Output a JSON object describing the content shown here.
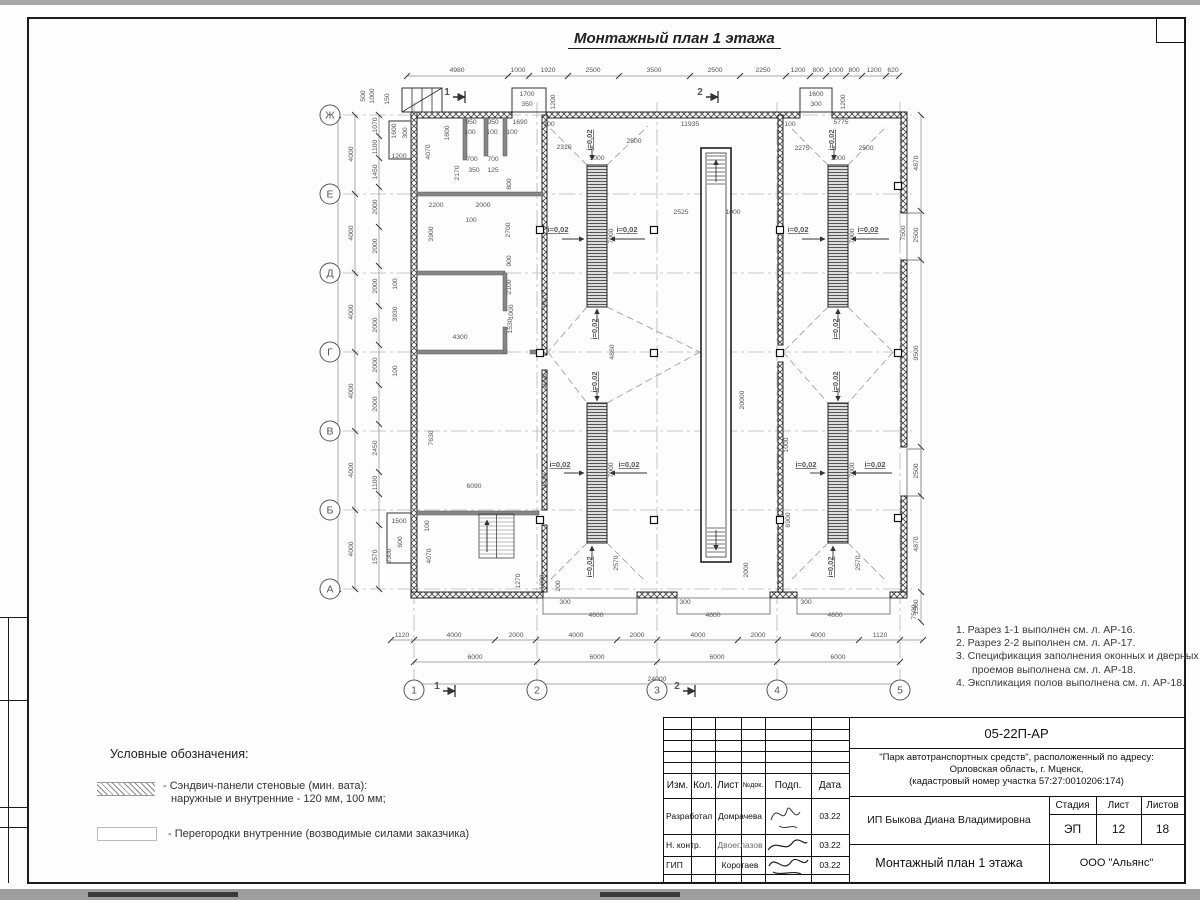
{
  "sheet": {
    "drawing_title": "Монтажный план 1 этажа",
    "doc_code": "05-22П-АР",
    "project_line1": "\"Парк автотранспортных средств\",  расположенный по адресу:",
    "project_line2": "Орловская область, г. Мценск,",
    "project_line3": "(кадастровый номер участка 57:27:0010206:174)",
    "client": "ИП Быкова Диана Владимировна",
    "sheet_title": "Монтажный план 1 этажа",
    "company": "ООО \"Альянс\"",
    "stage_label": "Стадия",
    "list_label": "Лист",
    "listov_label": "Листов",
    "stage": "ЭП",
    "sheet_no": "12",
    "sheets_total": "18",
    "col_izm": "Изм.",
    "col_kol": "Кол.",
    "col_list": "Лист",
    "col_ndok": "№док.",
    "col_podp": "Подп.",
    "col_data": "Дата",
    "row1_role": "Разработал",
    "row1_name": "Домрачева",
    "row1_date": "03.22",
    "row2_role": "Н. контр.",
    "row2_name": "Двоеглазов",
    "row2_date": "03.22",
    "row3_role": "ГИП",
    "row3_name": "Коротаев",
    "row3_date": "03.22"
  },
  "notes": {
    "items": [
      "1. Разрез 1-1 выполнен см. л. АР-16.",
      "2. Разрез 2-2 выполнен см. л. АР-17.",
      "3. Спецификация заполнения оконных и дверных",
      "проемов выполнена см. л. АР-18.",
      "4. Экспликация полов выполнена см. л. АР-18."
    ]
  },
  "legend": {
    "heading": "Условные обозначения:",
    "item1_line1": "- Сэндвич-панели стеновые (мин. вата):",
    "item1_line2": "наружные и внутренние - 120 мм, 100 мм;",
    "item2": "- Перегородки внутренние (возводимые силами заказчика)"
  },
  "plan": {
    "slope_text": "i=0,02",
    "axes_left": [
      {
        "l": "Ж",
        "y": 115
      },
      {
        "l": "Е",
        "y": 194
      },
      {
        "l": "Д",
        "y": 273
      },
      {
        "l": "Г",
        "y": 352
      },
      {
        "l": "В",
        "y": 431
      },
      {
        "l": "Б",
        "y": 510
      },
      {
        "l": "А",
        "y": 589
      }
    ],
    "axes_bottom": [
      {
        "l": "1",
        "x": 414
      },
      {
        "l": "2",
        "x": 537
      },
      {
        "l": "3",
        "x": 657
      },
      {
        "l": "4",
        "x": 777
      },
      {
        "l": "5",
        "x": 900
      }
    ],
    "sections": [
      {
        "t": "1",
        "x": 447,
        "y": 95
      },
      {
        "t": "2",
        "x": 700,
        "y": 95
      },
      {
        "t": "1",
        "x": 437,
        "y": 689
      },
      {
        "t": "2",
        "x": 677,
        "y": 689
      }
    ],
    "walls": [
      [
        411,
        112,
        101,
        6
      ],
      [
        546,
        112,
        254,
        6
      ],
      [
        832,
        112,
        74,
        6
      ],
      [
        411,
        112,
        6,
        486
      ],
      [
        901,
        112,
        6,
        101
      ],
      [
        901,
        260,
        6,
        187
      ],
      [
        901,
        496,
        6,
        96
      ],
      [
        411,
        592,
        132,
        6
      ],
      [
        637,
        592,
        40,
        6
      ],
      [
        770,
        592,
        27,
        6
      ],
      [
        890,
        592,
        17,
        6
      ],
      [
        542,
        115,
        5,
        240
      ],
      [
        542,
        370,
        5,
        140
      ],
      [
        542,
        525,
        5,
        67
      ],
      [
        778,
        115,
        5,
        230
      ],
      [
        778,
        362,
        5,
        230
      ]
    ],
    "partitions": [
      [
        417,
        192,
        126,
        4
      ],
      [
        417,
        271,
        88,
        4
      ],
      [
        503,
        273,
        4,
        38
      ],
      [
        417,
        350,
        90,
        4
      ],
      [
        530,
        350,
        13,
        4
      ],
      [
        503,
        327,
        4,
        26
      ],
      [
        417,
        511,
        122,
        4
      ],
      [
        463,
        118,
        4,
        42
      ],
      [
        484,
        118,
        4,
        38
      ],
      [
        503,
        118,
        4,
        38
      ]
    ],
    "outlines": [
      [
        512,
        88,
        34,
        24
      ],
      [
        800,
        88,
        32,
        24
      ],
      [
        402,
        88,
        40,
        24
      ],
      [
        389,
        121,
        22,
        38
      ],
      [
        387,
        513,
        24,
        50
      ]
    ],
    "aprons": [
      [
        543,
        598,
        94,
        16
      ],
      [
        677,
        598,
        93,
        16
      ],
      [
        797,
        598,
        93,
        16
      ],
      [
        907,
        213,
        14,
        47
      ],
      [
        907,
        449,
        14,
        47
      ]
    ],
    "pits": [
      [
        587,
        165,
        20,
        142
      ],
      [
        587,
        403,
        20,
        140
      ],
      [
        828,
        165,
        20,
        142
      ],
      [
        828,
        403,
        20,
        140
      ]
    ],
    "trench": {
      "outer": [
        701,
        148,
        30,
        414
      ],
      "inner": [
        706,
        153,
        20,
        404
      ],
      "stairs_top": [
        707,
        156,
        725,
        184
      ],
      "stairs_bot": [
        707,
        528,
        725,
        552
      ]
    },
    "stair_room": {
      "x": 479,
      "y": 514,
      "w": 35,
      "h": 44
    },
    "columns": [
      [
        540,
        230
      ],
      [
        540,
        353
      ],
      [
        540,
        520
      ],
      [
        654,
        230
      ],
      [
        654,
        353
      ],
      [
        654,
        520
      ],
      [
        780,
        230
      ],
      [
        780,
        353
      ],
      [
        780,
        520
      ],
      [
        898,
        186
      ],
      [
        898,
        353
      ],
      [
        898,
        518
      ]
    ],
    "dashes": [
      [
        587,
        307,
        548,
        352
      ],
      [
        548,
        352,
        587,
        403
      ],
      [
        607,
        307,
        700,
        352
      ],
      [
        700,
        352,
        607,
        403
      ],
      [
        828,
        307,
        783,
        352
      ],
      [
        783,
        352,
        828,
        403
      ],
      [
        848,
        307,
        893,
        352
      ],
      [
        893,
        352,
        848,
        403
      ],
      [
        587,
        165,
        548,
        126
      ],
      [
        607,
        165,
        648,
        126
      ],
      [
        828,
        165,
        789,
        126
      ],
      [
        848,
        165,
        887,
        126
      ],
      [
        587,
        543,
        548,
        582
      ],
      [
        607,
        543,
        646,
        582
      ],
      [
        828,
        543,
        789,
        582
      ],
      [
        848,
        543,
        887,
        582
      ]
    ],
    "chains": [
      {
        "o": "h",
        "c": 76,
        "ticks": [
          407,
          508,
          529,
          568,
          619,
          690,
          740,
          786,
          810,
          826,
          846,
          862,
          886,
          899
        ]
      },
      {
        "o": "v",
        "c": 355,
        "ticks": [
          115,
          194,
          273,
          352,
          431,
          510,
          589
        ]
      },
      {
        "o": "v",
        "c": 338,
        "ticks": [
          115,
          589
        ]
      },
      {
        "o": "v",
        "c": 379,
        "ticks": [
          115,
          136,
          158,
          187,
          227,
          266,
          306,
          345,
          385,
          424,
          472,
          494,
          525,
          589
        ]
      },
      {
        "o": "h",
        "c": 640,
        "ticks": [
          391,
          414,
          495,
          536,
          617,
          657,
          738,
          778,
          859,
          900,
          923
        ]
      },
      {
        "o": "h",
        "c": 662,
        "ticks": [
          414,
          537,
          657,
          777,
          900
        ]
      },
      {
        "o": "h",
        "c": 684,
        "ticks": [
          414,
          900
        ]
      },
      {
        "o": "v",
        "c": 921,
        "ticks": [
          115,
          211,
          260,
          447,
          496,
          592,
          622
        ]
      }
    ],
    "labels": [
      [
        457,
        72,
        "4980"
      ],
      [
        518,
        72,
        "1000"
      ],
      [
        548,
        72,
        "1920"
      ],
      [
        593,
        72,
        "2500"
      ],
      [
        654,
        72,
        "3500"
      ],
      [
        715,
        72,
        "2500"
      ],
      [
        763,
        72,
        "2250"
      ],
      [
        798,
        72,
        "1200"
      ],
      [
        818,
        72,
        "800"
      ],
      [
        836,
        72,
        "1000"
      ],
      [
        854,
        72,
        "800"
      ],
      [
        874,
        72,
        "1200"
      ],
      [
        893,
        72,
        "620"
      ],
      [
        527,
        96,
        "1700"
      ],
      [
        527,
        106,
        "350"
      ],
      [
        555,
        102,
        "1200",
        1
      ],
      [
        816,
        96,
        "1600"
      ],
      [
        816,
        106,
        "300"
      ],
      [
        845,
        102,
        "1200",
        1
      ],
      [
        365,
        96,
        "500",
        1
      ],
      [
        374,
        96,
        "1000",
        1
      ],
      [
        389,
        99,
        "150",
        1
      ],
      [
        549,
        126,
        "100"
      ],
      [
        690,
        126,
        "11935"
      ],
      [
        790,
        126,
        "100"
      ],
      [
        841,
        124,
        "5775"
      ],
      [
        564,
        149,
        "2310"
      ],
      [
        634,
        143,
        "2500"
      ],
      [
        802,
        150,
        "2275"
      ],
      [
        866,
        150,
        "2500"
      ],
      [
        597,
        160,
        "1000"
      ],
      [
        838,
        160,
        "1000"
      ],
      [
        336,
        352,
        "24000",
        1
      ],
      [
        353,
        154,
        "4000",
        1
      ],
      [
        353,
        233,
        "4000",
        1
      ],
      [
        353,
        312,
        "4000",
        1
      ],
      [
        353,
        391,
        "4000",
        1
      ],
      [
        353,
        470,
        "4000",
        1
      ],
      [
        353,
        549,
        "4000",
        1
      ],
      [
        377,
        125,
        "1070",
        1
      ],
      [
        377,
        147,
        "1100",
        1
      ],
      [
        377,
        172,
        "1450",
        1
      ],
      [
        377,
        207,
        "2000",
        1
      ],
      [
        377,
        246,
        "2000",
        1
      ],
      [
        377,
        286,
        "2000",
        1
      ],
      [
        377,
        325,
        "2000",
        1
      ],
      [
        377,
        365,
        "2000",
        1
      ],
      [
        377,
        404,
        "2000",
        1
      ],
      [
        377,
        448,
        "2450",
        1
      ],
      [
        377,
        483,
        "1100",
        1
      ],
      [
        377,
        557,
        "1570",
        1
      ],
      [
        402,
        637,
        "1120"
      ],
      [
        454,
        637,
        "4000"
      ],
      [
        516,
        637,
        "2000"
      ],
      [
        576,
        637,
        "4000"
      ],
      [
        637,
        637,
        "2000"
      ],
      [
        698,
        637,
        "4000"
      ],
      [
        758,
        637,
        "2000"
      ],
      [
        818,
        637,
        "4000"
      ],
      [
        880,
        637,
        "1120"
      ],
      [
        475,
        659,
        "6000"
      ],
      [
        597,
        659,
        "6000"
      ],
      [
        717,
        659,
        "6000"
      ],
      [
        838,
        659,
        "6000"
      ],
      [
        657,
        681,
        "24000"
      ],
      [
        918,
        163,
        "4870",
        1
      ],
      [
        918,
        235,
        "2500",
        1
      ],
      [
        918,
        353,
        "9500",
        1
      ],
      [
        918,
        471,
        "2500",
        1
      ],
      [
        918,
        544,
        "4870",
        1
      ],
      [
        918,
        607,
        "1500",
        1
      ],
      [
        905,
        233,
        "7500",
        1
      ],
      [
        916,
        612,
        "7500",
        1
      ],
      [
        565,
        604,
        "300"
      ],
      [
        685,
        604,
        "300"
      ],
      [
        806,
        604,
        "300"
      ],
      [
        596,
        617,
        "4600"
      ],
      [
        713,
        617,
        "4600"
      ],
      [
        835,
        617,
        "4600"
      ],
      [
        613,
        236,
        "7000",
        1
      ],
      [
        854,
        236,
        "7000",
        1
      ],
      [
        613,
        470,
        "7000",
        1
      ],
      [
        854,
        470,
        "7000",
        1
      ],
      [
        618,
        563,
        "2570",
        1
      ],
      [
        860,
        563,
        "2570",
        1
      ],
      [
        614,
        352,
        "4860",
        1
      ],
      [
        788,
        445,
        "1000",
        1
      ],
      [
        681,
        214,
        "2525"
      ],
      [
        733,
        214,
        "1000"
      ],
      [
        744,
        400,
        "20000",
        1
      ],
      [
        790,
        520,
        "6900",
        1
      ],
      [
        748,
        570,
        "2000",
        1
      ],
      [
        546,
        300,
        "9670",
        1
      ],
      [
        546,
        381,
        "1000",
        1
      ],
      [
        546,
        481,
        "9130",
        1
      ],
      [
        471,
        124,
        "950"
      ],
      [
        493,
        124,
        "950"
      ],
      [
        520,
        124,
        "1690"
      ],
      [
        470,
        134,
        "100"
      ],
      [
        492,
        134,
        "100"
      ],
      [
        512,
        134,
        "100"
      ],
      [
        449,
        133,
        "1800",
        1
      ],
      [
        430,
        152,
        "4070",
        1
      ],
      [
        459,
        173,
        "2170",
        1
      ],
      [
        472,
        161,
        "700"
      ],
      [
        493,
        161,
        "700"
      ],
      [
        474,
        172,
        "350"
      ],
      [
        493,
        172,
        "125"
      ],
      [
        511,
        184,
        "800",
        1
      ],
      [
        436,
        207,
        "2200"
      ],
      [
        483,
        207,
        "2000"
      ],
      [
        471,
        222,
        "100"
      ],
      [
        433,
        234,
        "3900",
        1
      ],
      [
        510,
        230,
        "2700",
        1
      ],
      [
        511,
        261,
        "900",
        1
      ],
      [
        396,
        131,
        "1600",
        1
      ],
      [
        407,
        133,
        "300",
        1
      ],
      [
        399,
        158,
        "1200"
      ],
      [
        397,
        284,
        "100",
        1
      ],
      [
        397,
        314,
        "3930",
        1
      ],
      [
        460,
        339,
        "4300"
      ],
      [
        511,
        287,
        "2100",
        1
      ],
      [
        513,
        312,
        "1000",
        1
      ],
      [
        512,
        326,
        "1530",
        1
      ],
      [
        397,
        371,
        "100",
        1
      ],
      [
        433,
        438,
        "7630",
        1
      ],
      [
        474,
        488,
        "6090"
      ],
      [
        399,
        523,
        "1500"
      ],
      [
        402,
        542,
        "600",
        1
      ],
      [
        391,
        556,
        "2300",
        1
      ],
      [
        429,
        526,
        "100",
        1
      ],
      [
        431,
        556,
        "4070",
        1
      ],
      [
        520,
        581,
        "1270",
        1
      ],
      [
        544,
        582,
        "1000",
        1
      ],
      [
        560,
        586,
        "200",
        1
      ]
    ],
    "slopes_h": [
      [
        558,
        232
      ],
      [
        627,
        232
      ],
      [
        798,
        232
      ],
      [
        868,
        232
      ],
      [
        560,
        467
      ],
      [
        629,
        467
      ],
      [
        806,
        467
      ],
      [
        875,
        467
      ]
    ],
    "slopes_v": [
      [
        592,
        140
      ],
      [
        834,
        140
      ],
      [
        597,
        329
      ],
      [
        838,
        329
      ],
      [
        597,
        382
      ],
      [
        838,
        382
      ],
      [
        592,
        567
      ],
      [
        833,
        567
      ]
    ],
    "arrows": [
      [
        562,
        239,
        584,
        239
      ],
      [
        645,
        239,
        610,
        239
      ],
      [
        802,
        239,
        825,
        239
      ],
      [
        889,
        239,
        851,
        239
      ],
      [
        564,
        473,
        584,
        473
      ],
      [
        647,
        473,
        610,
        473
      ],
      [
        810,
        473,
        825,
        473
      ],
      [
        892,
        473,
        851,
        473
      ],
      [
        592,
        146,
        592,
        160
      ],
      [
        834,
        146,
        834,
        160
      ],
      [
        597,
        322,
        597,
        309
      ],
      [
        838,
        322,
        838,
        309
      ],
      [
        597,
        388,
        597,
        401
      ],
      [
        838,
        388,
        838,
        401
      ],
      [
        592,
        560,
        592,
        546
      ],
      [
        833,
        560,
        833,
        546
      ]
    ]
  }
}
